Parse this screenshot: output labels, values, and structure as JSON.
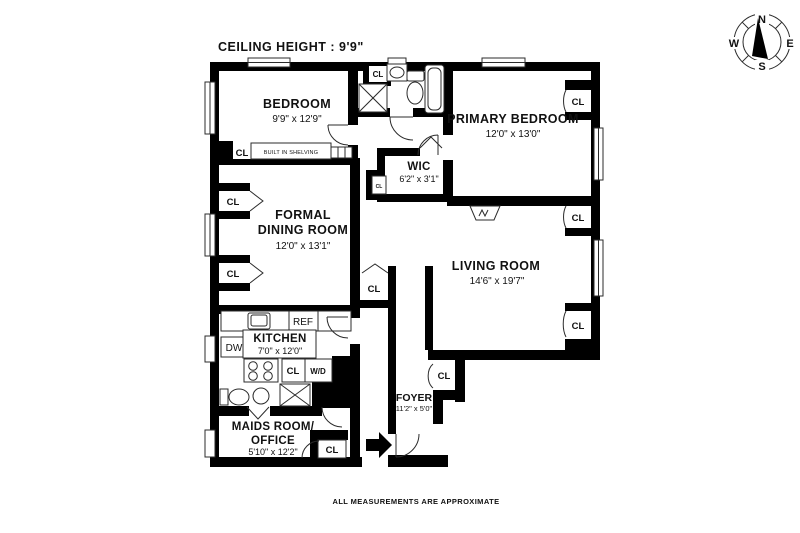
{
  "header": {
    "ceiling_height": "CEILING HEIGHT : 9'9\""
  },
  "compass": {
    "north": "N",
    "east": "E",
    "south": "S",
    "west": "W"
  },
  "rooms": {
    "bedroom": {
      "name": "BEDROOM",
      "dims": "9'9\" x 12'9\""
    },
    "primary_bedroom": {
      "name": "PRIMARY BEDROOM",
      "dims": "12'0\" x 13'0\""
    },
    "wic": {
      "name": "WIC",
      "dims": "6'2\" x 3'1\""
    },
    "dining_room": {
      "line1": "FORMAL",
      "line2": "DINING ROOM",
      "dims": "12'0\" x 13'1\""
    },
    "living_room": {
      "name": "LIVING ROOM",
      "dims": "14'6\" x 19'7\""
    },
    "kitchen": {
      "name": "KITCHEN",
      "dims": "7'0\" x 12'0\""
    },
    "maids_room": {
      "line1": "MAIDS ROOM/",
      "line2": "OFFICE",
      "dims": "5'10\" x 12'2\""
    },
    "foyer": {
      "name": "FOYER",
      "dims": "11'2\" x 5'0\""
    }
  },
  "labels": {
    "closet": "CL",
    "refrigerator": "REF",
    "dishwasher": "DW",
    "washer_dryer": "W/D",
    "built_in_shelving": "BUILT IN SHELVING"
  },
  "footer": {
    "disclaimer": "ALL MEASUREMENTS ARE APPROXIMATE"
  },
  "colors": {
    "wall": "#000000",
    "line": "#2b2b2b",
    "background": "#ffffff"
  }
}
